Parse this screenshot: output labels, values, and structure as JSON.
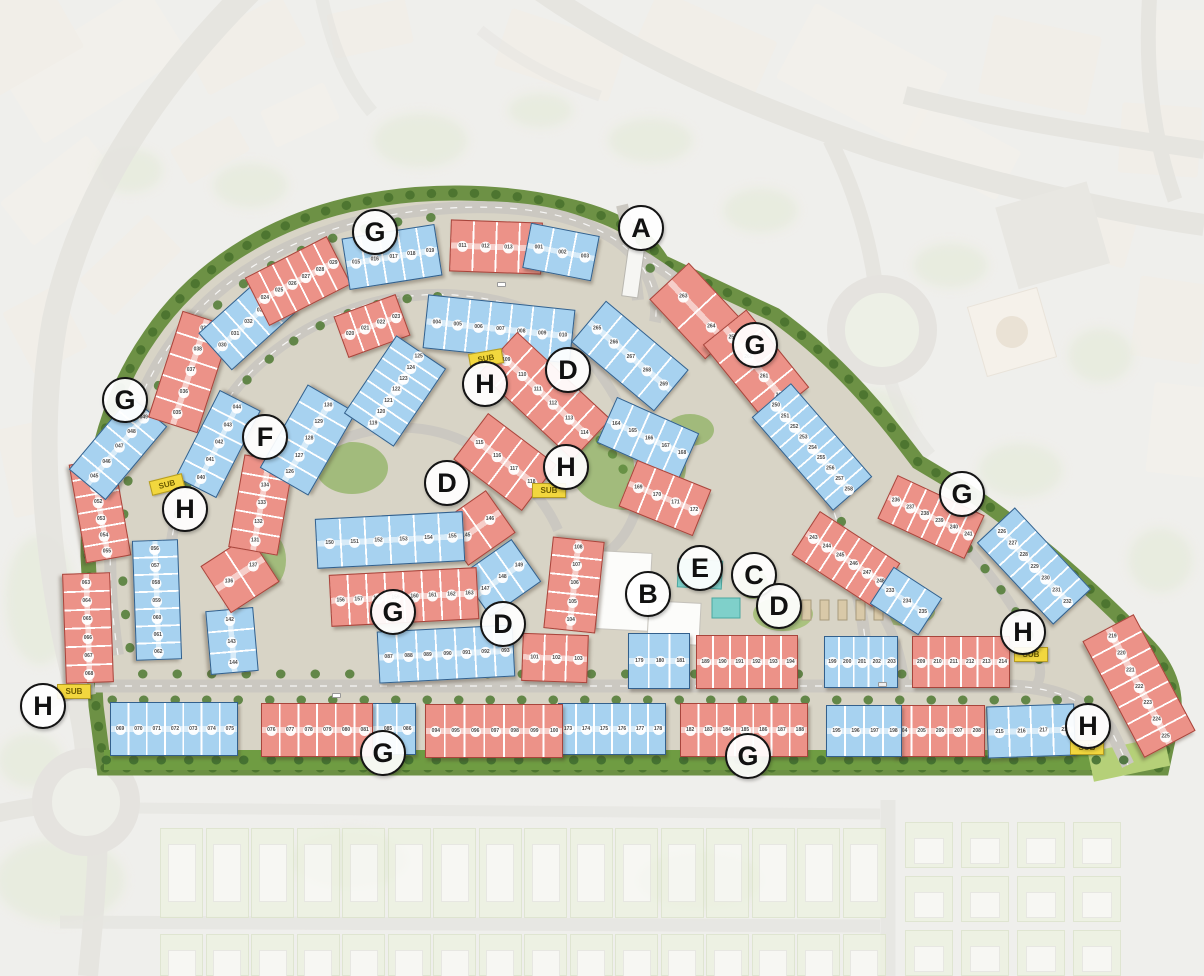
{
  "map": {
    "title": "residential-community-master-plan",
    "building_colors": {
      "red": "#ec9288",
      "blue": "#a7d2f0"
    },
    "unit_number_format": "zero-padded-3-digits",
    "badges": [
      {
        "id": "a",
        "label": "A",
        "x": 641,
        "y": 228
      },
      {
        "id": "g-top",
        "label": "G",
        "x": 375,
        "y": 232
      },
      {
        "id": "g-left",
        "label": "G",
        "x": 125,
        "y": 400
      },
      {
        "id": "f",
        "label": "F",
        "x": 265,
        "y": 437
      },
      {
        "id": "h-top",
        "label": "H",
        "x": 485,
        "y": 384
      },
      {
        "id": "d-top",
        "label": "D",
        "x": 568,
        "y": 370
      },
      {
        "id": "h-mid",
        "label": "H",
        "x": 566,
        "y": 467
      },
      {
        "id": "d-mid-left",
        "label": "D",
        "x": 447,
        "y": 483
      },
      {
        "id": "h-left",
        "label": "H",
        "x": 185,
        "y": 509
      },
      {
        "id": "g-upper-right",
        "label": "G",
        "x": 755,
        "y": 345
      },
      {
        "id": "g-right",
        "label": "G",
        "x": 962,
        "y": 494
      },
      {
        "id": "b",
        "label": "B",
        "x": 648,
        "y": 594
      },
      {
        "id": "e",
        "label": "E",
        "x": 700,
        "y": 568
      },
      {
        "id": "c",
        "label": "C",
        "x": 754,
        "y": 575
      },
      {
        "id": "d-right",
        "label": "D",
        "x": 779,
        "y": 606
      },
      {
        "id": "g-center",
        "label": "G",
        "x": 393,
        "y": 612
      },
      {
        "id": "d-center",
        "label": "D",
        "x": 503,
        "y": 624
      },
      {
        "id": "h-right",
        "label": "H",
        "x": 1023,
        "y": 632
      },
      {
        "id": "h-bottom-left",
        "label": "H",
        "x": 43,
        "y": 706
      },
      {
        "id": "g-bottom-left",
        "label": "G",
        "x": 383,
        "y": 753
      },
      {
        "id": "g-bottom-right",
        "label": "G",
        "x": 748,
        "y": 756
      },
      {
        "id": "h-bottom-right",
        "label": "H",
        "x": 1088,
        "y": 726
      }
    ],
    "substations": [
      {
        "label": "SUB",
        "x": 167,
        "y": 485,
        "rot": -14
      },
      {
        "label": "SUB",
        "x": 486,
        "y": 359,
        "rot": -10
      },
      {
        "label": "SUB",
        "x": 549,
        "y": 491,
        "rot": 0
      },
      {
        "label": "SUB",
        "x": 74,
        "y": 692,
        "rot": 0
      },
      {
        "label": "SUB",
        "x": 1031,
        "y": 655,
        "rot": 0
      },
      {
        "label": "SUB",
        "x": 1087,
        "y": 748,
        "rot": 0
      }
    ],
    "buildings": [
      {
        "x": 100,
        "y": 510,
        "w": 100,
        "h": 46,
        "rot": 80,
        "color": "red",
        "from": 50,
        "to": 55
      },
      {
        "x": 88,
        "y": 628,
        "w": 110,
        "h": 48,
        "rot": 88,
        "color": "red",
        "from": 63,
        "to": 68
      },
      {
        "x": 157,
        "y": 600,
        "w": 120,
        "h": 46,
        "rot": 88,
        "color": "blue",
        "from": 56,
        "to": 62
      },
      {
        "x": 118,
        "y": 448,
        "w": 96,
        "h": 48,
        "rot": -50,
        "color": "blue",
        "from": 45,
        "to": 49
      },
      {
        "x": 190,
        "y": 372,
        "w": 112,
        "h": 52,
        "rot": -72,
        "color": "red",
        "from": 35,
        "to": 39
      },
      {
        "x": 218,
        "y": 444,
        "w": 98,
        "h": 46,
        "rot": -63,
        "color": "blue",
        "from": 40,
        "to": 44
      },
      {
        "x": 247,
        "y": 323,
        "w": 86,
        "h": 50,
        "rot": -42,
        "color": "blue",
        "from": 30,
        "to": 34
      },
      {
        "x": 298,
        "y": 281,
        "w": 92,
        "h": 54,
        "rot": -27,
        "color": "red",
        "from": 24,
        "to": 29
      },
      {
        "x": 372,
        "y": 326,
        "w": 66,
        "h": 44,
        "rot": -20,
        "color": "red",
        "from": 20,
        "to": 23
      },
      {
        "x": 392,
        "y": 257,
        "w": 94,
        "h": 52,
        "rot": -9,
        "color": "blue",
        "from": 15,
        "to": 19
      },
      {
        "x": 496,
        "y": 247,
        "w": 92,
        "h": 52,
        "rot": 2,
        "color": "red",
        "from": 11,
        "to": 14
      },
      {
        "x": 561,
        "y": 252,
        "w": 70,
        "h": 46,
        "rot": 11,
        "color": "blue",
        "from": 1,
        "to": 3
      },
      {
        "x": 499,
        "y": 329,
        "w": 148,
        "h": 54,
        "rot": 6,
        "color": "blue",
        "from": 4,
        "to": 10
      },
      {
        "x": 697,
        "y": 311,
        "w": 82,
        "h": 54,
        "rot": 47,
        "color": "red",
        "from": 263,
        "to": 264
      },
      {
        "x": 756,
        "y": 366,
        "w": 100,
        "h": 56,
        "rot": 51,
        "color": "red",
        "from": 259,
        "to": 262
      },
      {
        "x": 812,
        "y": 447,
        "w": 124,
        "h": 52,
        "rot": 49,
        "color": "blue",
        "from": 250,
        "to": 258
      },
      {
        "x": 846,
        "y": 559,
        "w": 96,
        "h": 52,
        "rot": 33,
        "color": "red",
        "from": 243,
        "to": 248
      },
      {
        "x": 931,
        "y": 517,
        "w": 96,
        "h": 48,
        "rot": 25,
        "color": "red",
        "from": 236,
        "to": 241
      },
      {
        "x": 906,
        "y": 601,
        "w": 58,
        "h": 44,
        "rot": 33,
        "color": "blue",
        "from": 233,
        "to": 235
      },
      {
        "x": 1034,
        "y": 566,
        "w": 112,
        "h": 52,
        "rot": 47,
        "color": "blue",
        "from": 226,
        "to": 232
      },
      {
        "x": 1139,
        "y": 686,
        "w": 132,
        "h": 58,
        "rot": 62,
        "color": "red",
        "from": 219,
        "to": 225
      },
      {
        "x": 1031,
        "y": 731,
        "w": 88,
        "h": 52,
        "rot": -2,
        "color": "blue",
        "from": 215,
        "to": 218
      },
      {
        "x": 939,
        "y": 731,
        "w": 92,
        "h": 52,
        "rot": 0,
        "color": "red",
        "from": 204,
        "to": 208
      },
      {
        "x": 864,
        "y": 731,
        "w": 76,
        "h": 52,
        "rot": 0,
        "color": "blue",
        "from": 195,
        "to": 198
      },
      {
        "x": 744,
        "y": 730,
        "w": 128,
        "h": 54,
        "rot": 0,
        "color": "red",
        "from": 182,
        "to": 188
      },
      {
        "x": 612,
        "y": 729,
        "w": 108,
        "h": 52,
        "rot": 0,
        "color": "blue",
        "from": 173,
        "to": 178
      },
      {
        "x": 494,
        "y": 731,
        "w": 138,
        "h": 54,
        "rot": 0,
        "color": "red",
        "from": 94,
        "to": 100
      },
      {
        "x": 387,
        "y": 729,
        "w": 58,
        "h": 52,
        "rot": 0,
        "color": "blue",
        "from": 84,
        "to": 86
      },
      {
        "x": 317,
        "y": 730,
        "w": 112,
        "h": 54,
        "rot": 0,
        "color": "red",
        "from": 76,
        "to": 81
      },
      {
        "x": 174,
        "y": 729,
        "w": 128,
        "h": 54,
        "rot": 0,
        "color": "blue",
        "from": 69,
        "to": 75
      },
      {
        "x": 232,
        "y": 641,
        "w": 64,
        "h": 48,
        "rot": 85,
        "color": "blue",
        "from": 142,
        "to": 144
      },
      {
        "x": 240,
        "y": 574,
        "w": 58,
        "h": 56,
        "rot": -33,
        "color": "red",
        "from": 136,
        "to": 137
      },
      {
        "x": 261,
        "y": 505,
        "w": 94,
        "h": 50,
        "rot": -80,
        "color": "red",
        "from": 131,
        "to": 135
      },
      {
        "x": 308,
        "y": 440,
        "w": 96,
        "h": 56,
        "rot": -60,
        "color": "blue",
        "from": 126,
        "to": 130
      },
      {
        "x": 395,
        "y": 391,
        "w": 94,
        "h": 60,
        "rot": -56,
        "color": "blue",
        "from": 119,
        "to": 125
      },
      {
        "x": 505,
        "y": 462,
        "w": 86,
        "h": 58,
        "rot": 37,
        "color": "red",
        "from": 115,
        "to": 118
      },
      {
        "x": 545,
        "y": 396,
        "w": 128,
        "h": 56,
        "rot": 43,
        "color": "red",
        "from": 109,
        "to": 114
      },
      {
        "x": 630,
        "y": 356,
        "w": 108,
        "h": 54,
        "rot": 40,
        "color": "blue",
        "from": 265,
        "to": 269
      },
      {
        "x": 648,
        "y": 438,
        "w": 90,
        "h": 50,
        "rot": 24,
        "color": "blue",
        "from": 164,
        "to": 168
      },
      {
        "x": 665,
        "y": 498,
        "w": 80,
        "h": 50,
        "rot": 22,
        "color": "red",
        "from": 169,
        "to": 172
      },
      {
        "x": 477,
        "y": 528,
        "w": 58,
        "h": 52,
        "rot": -35,
        "color": "red",
        "from": 145,
        "to": 146
      },
      {
        "x": 501,
        "y": 578,
        "w": 62,
        "h": 52,
        "rot": -35,
        "color": "blue",
        "from": 147,
        "to": 149
      },
      {
        "x": 390,
        "y": 540,
        "w": 148,
        "h": 50,
        "rot": -3,
        "color": "blue",
        "from": 150,
        "to": 155
      },
      {
        "x": 404,
        "y": 597,
        "w": 148,
        "h": 52,
        "rot": -3,
        "color": "red",
        "from": 156,
        "to": 163
      },
      {
        "x": 446,
        "y": 654,
        "w": 136,
        "h": 52,
        "rot": -3,
        "color": "blue",
        "from": 87,
        "to": 93
      },
      {
        "x": 555,
        "y": 658,
        "w": 66,
        "h": 48,
        "rot": 2,
        "color": "red",
        "from": 101,
        "to": 103
      },
      {
        "x": 574,
        "y": 585,
        "w": 92,
        "h": 52,
        "rot": -84,
        "color": "red",
        "from": 104,
        "to": 108
      },
      {
        "x": 659,
        "y": 661,
        "w": 62,
        "h": 56,
        "rot": 0,
        "color": "blue",
        "from": 179,
        "to": 181
      },
      {
        "x": 747,
        "y": 662,
        "w": 102,
        "h": 54,
        "rot": 0,
        "color": "red",
        "from": 189,
        "to": 194
      },
      {
        "x": 861,
        "y": 662,
        "w": 74,
        "h": 52,
        "rot": 0,
        "color": "blue",
        "from": 199,
        "to": 203
      },
      {
        "x": 961,
        "y": 662,
        "w": 98,
        "h": 52,
        "rot": 0,
        "color": "red",
        "from": 209,
        "to": 214
      }
    ]
  }
}
